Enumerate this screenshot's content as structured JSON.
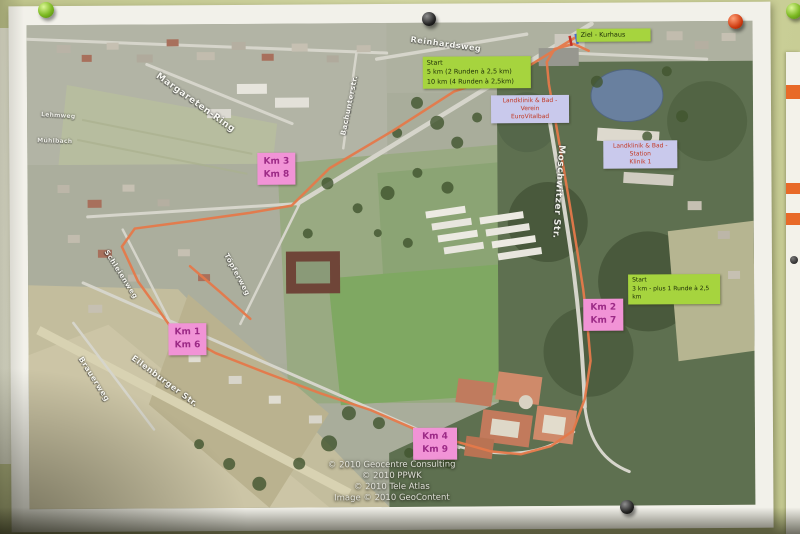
{
  "sheet": {
    "street_labels": [
      {
        "text": "Reinhardsweg"
      },
      {
        "text": "Margareten-Ring"
      },
      {
        "text": "Bachunterstr."
      },
      {
        "text": "Moschwitzer Str."
      },
      {
        "text": "Schleienweg"
      },
      {
        "text": "Töpferweg"
      },
      {
        "text": "Brauerweg"
      },
      {
        "text": "Eilenburger Str."
      },
      {
        "text": "Lehmweg"
      },
      {
        "text": "Mühlbach"
      }
    ],
    "labels": {
      "start_main": {
        "line1": "Start",
        "line2": "5 km (2 Runden à 2,5 km)",
        "line3": "10 km (4 Runden à 2,5km)"
      },
      "ziel": {
        "text": "Ziel - Kurhaus"
      },
      "start_3km": {
        "line1": "Start",
        "line2": "3 km - plus 1 Runde à 2,5 km"
      },
      "klinik_verein": {
        "line1": "Landklinik & Bad - Verein",
        "line2": "EuroVitalbad"
      },
      "klinik_station": {
        "line1": "Landklinik & Bad - Station",
        "line2": "Klinik 1"
      }
    },
    "km_markers": [
      {
        "line1": "Km 3",
        "line2": "Km 8"
      },
      {
        "line1": "Km 1",
        "line2": "Km 6"
      },
      {
        "line1": "Km 2",
        "line2": "Km 7"
      },
      {
        "line1": "Km 4",
        "line2": "Km 9"
      }
    ],
    "copyright": [
      "© 2010 Geocentre Consulting",
      "© 2010 PPWK",
      "© 2010 Tele Atlas",
      "Image © 2010 GeoContent"
    ],
    "colors": {
      "route": "#e5794a",
      "label_green": "#a6d43e",
      "label_pink": "#f193d6",
      "label_lavender": "#c9c9ec",
      "board": "#c9cf96",
      "pond": "#69809f"
    }
  }
}
